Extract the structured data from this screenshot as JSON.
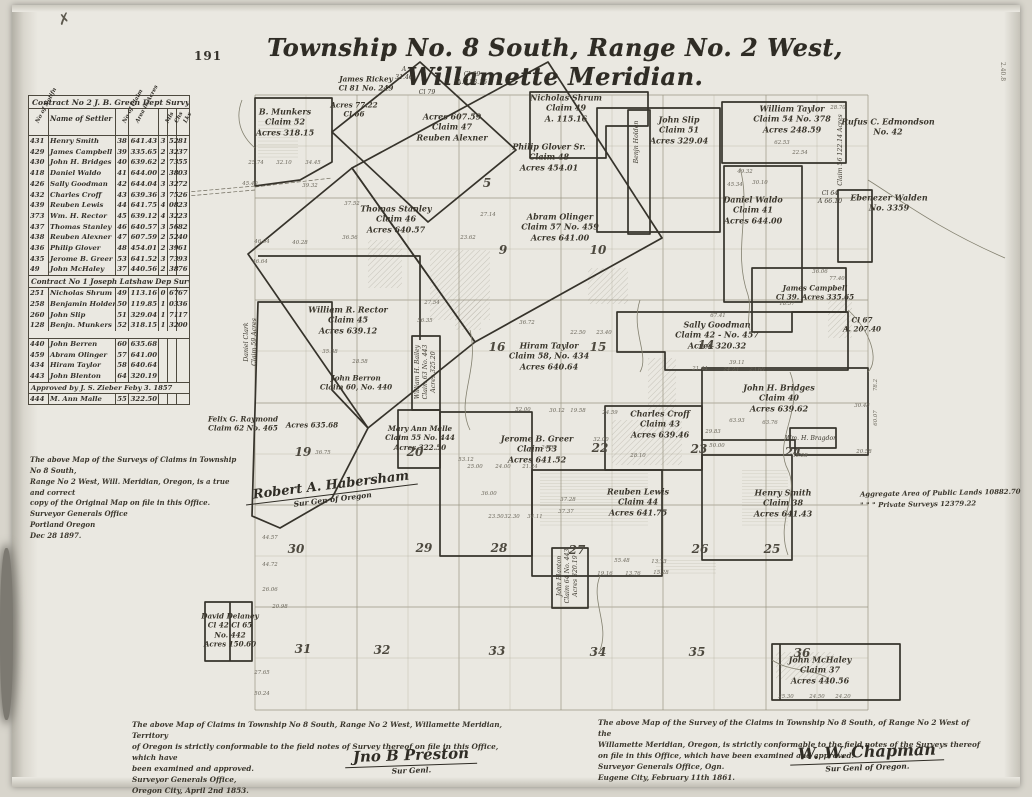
{
  "page": {
    "number": "191",
    "corner_mark": "✗",
    "right_edge_mark": "2.40.8"
  },
  "title": "Township No. 8 South, Range No. 2 West, Willamette Meridian.",
  "table": {
    "contract2_header": "Contract No 2 J. B. Green  Dept Survy",
    "contract1_header": "Contract No 1 Joseph Latshaw Dep Survy",
    "approved_note": "Approved by J. S. Zieber   Feby 3. 1857",
    "col": {
      "notif": "No of Notifn",
      "name": "Name of Settler",
      "claim": "No of Claim",
      "area": "Area in Acres",
      "m": "Mls",
      "c": "Chs",
      "l": "Lks"
    },
    "rows": [
      {
        "n": "431",
        "name": "Henry Smith",
        "c": "38",
        "a": "641.43",
        "s1": "3",
        "s2": "52",
        "s3": "81"
      },
      {
        "n": "429",
        "name": "James Campbell",
        "c": "39",
        "a": "335.65",
        "s1": "2",
        "s2": "32",
        "s3": "37"
      },
      {
        "n": "430",
        "name": "John H. Bridges",
        "c": "40",
        "a": "639.62",
        "s1": "2",
        "s2": "73",
        "s3": "55"
      },
      {
        "n": "418",
        "name": "Daniel Waldo",
        "c": "41",
        "a": "644.00",
        "s1": "2",
        "s2": "38",
        "s3": "03"
      },
      {
        "n": "426",
        "name": "Sally Goodman",
        "c": "42",
        "a": "644.04",
        "s1": "3",
        "s2": "32",
        "s3": "72"
      },
      {
        "n": "432",
        "name": "Charles Croff",
        "c": "43",
        "a": "639.36",
        "s1": "3",
        "s2": "75",
        "s3": "26"
      },
      {
        "n": "439",
        "name": "Reuben Lewis",
        "c": "44",
        "a": "641.75",
        "s1": "4",
        "s2": "08",
        "s3": "23"
      },
      {
        "n": "373",
        "name": "Wm. H. Rector",
        "c": "45",
        "a": "639.12",
        "s1": "4",
        "s2": "32",
        "s3": "23"
      },
      {
        "n": "437",
        "name": "Thomas Stanley",
        "c": "46",
        "a": "640.57",
        "s1": "3",
        "s2": "56",
        "s3": "82"
      },
      {
        "n": "438",
        "name": "Reuben Alexner",
        "c": "47",
        "a": "607.59",
        "s1": "2",
        "s2": "52",
        "s3": "40"
      },
      {
        "n": "436",
        "name": "Philip Glover",
        "c": "48",
        "a": "454.01",
        "s1": "2",
        "s2": "39",
        "s3": "61"
      },
      {
        "n": "435",
        "name": "Jerome B. Greer",
        "c": "53",
        "a": "641.52",
        "s1": "3",
        "s2": "73",
        "s3": "93"
      },
      {
        "n": "49",
        "name": "John McHaley",
        "c": "37",
        "a": "440.56",
        "s1": "2",
        "s2": "38",
        "s3": "76"
      }
    ],
    "rows2": [
      {
        "n": "251",
        "name": "Nicholas Shrum",
        "c": "49",
        "a": "113.16",
        "s1": "0",
        "s2": "67",
        "s3": "67"
      },
      {
        "n": "258",
        "name": "Benjamin Holden",
        "c": "50",
        "a": "119.85",
        "s1": "1",
        "s2": "03",
        "s3": "36"
      },
      {
        "n": "260",
        "name": "John Slip",
        "c": "51",
        "a": "329.04",
        "s1": "1",
        "s2": "71",
        "s3": "17"
      },
      {
        "n": "128",
        "name": "Benjn. Munkers",
        "c": "52",
        "a": "318.15",
        "s1": "1",
        "s2": "32",
        "s3": "00"
      }
    ],
    "rows3": [
      {
        "n": "440",
        "name": "John Berren",
        "c": "60",
        "a": "635.68",
        "s1": "",
        "s2": "",
        "s3": ""
      },
      {
        "n": "459",
        "name": "Abram Olinger",
        "c": "57",
        "a": "641.00",
        "s1": "",
        "s2": "",
        "s3": ""
      },
      {
        "n": "434",
        "name": "Hiram Taylor",
        "c": "58",
        "a": "640.64",
        "s1": "",
        "s2": "",
        "s3": ""
      },
      {
        "n": "443",
        "name": "John Blenton",
        "c": "64",
        "a": "320.19",
        "s1": "",
        "s2": "",
        "s3": ""
      }
    ],
    "rows4": [
      {
        "n": "444",
        "name": "M. Ann Malle",
        "c": "55",
        "a": "322.50",
        "s1": "",
        "s2": "",
        "s3": ""
      }
    ]
  },
  "map": {
    "claims": [
      {
        "id": "munkers",
        "x": 285,
        "y": 122,
        "text": "B. Munkers\nClaim 52\nAcres 318.15"
      },
      {
        "id": "rickey",
        "x": 366,
        "y": 84,
        "cls": "sm",
        "text": "James Rickey\nCl 81  No. 249"
      },
      {
        "id": "a3146",
        "x": 404,
        "y": 74,
        "cls": "xs",
        "text": "A\n31.46"
      },
      {
        "id": "cl79",
        "x": 427,
        "y": 93,
        "cls": "xs",
        "text": "Cl 79"
      },
      {
        "id": "cl69",
        "x": 472,
        "y": 79,
        "cls": "xs",
        "text": "Cl 69\nA. 153.15"
      },
      {
        "id": "cl66",
        "x": 354,
        "y": 110,
        "cls": "sm",
        "text": "Acres 77.22\nCl 66"
      },
      {
        "id": "alexander",
        "x": 452,
        "y": 127,
        "text": "Acres 607.59\nClaim 47\nReuben Alexner"
      },
      {
        "id": "shrum",
        "x": 566,
        "y": 108,
        "text": "Nicholas Shrum\nClaim 49\nA. 115.16"
      },
      {
        "id": "glover",
        "x": 549,
        "y": 157,
        "text": "Philip Glover Sr.\nClaim 48\nAcres 454.01"
      },
      {
        "id": "slip",
        "x": 679,
        "y": 130,
        "text": "John Slip\nClaim 51\nAcres 329.04"
      },
      {
        "id": "holden-vert",
        "x": 637,
        "y": 142,
        "rot": -90,
        "cls": "xs",
        "text": "Benjn Holden"
      },
      {
        "id": "wtaylor",
        "x": 792,
        "y": 119,
        "text": "William Taylor\nClaim 54  No. 378\nAcres 248.59"
      },
      {
        "id": "edmondson",
        "x": 888,
        "y": 127,
        "text": "Rufus C. Edmondson\nNo. 42"
      },
      {
        "id": "claim56-vert",
        "x": 841,
        "y": 150,
        "rot": -90,
        "cls": "xs",
        "text": "Claim 56   122.14 Acres"
      },
      {
        "id": "waldo",
        "x": 753,
        "y": 210,
        "text": "Daniel Waldo\nClaim 41\nAcres 644.00"
      },
      {
        "id": "walden",
        "x": 889,
        "y": 203,
        "text": "Ebenezer Walden\nNo. 3359"
      },
      {
        "id": "cl64",
        "x": 830,
        "y": 198,
        "cls": "xs",
        "text": "Cl 64\nA 66.10"
      },
      {
        "id": "stanley",
        "x": 396,
        "y": 219,
        "text": "Thomas Stanley\nClaim 46\nAcres 640.57"
      },
      {
        "id": "olinger",
        "x": 560,
        "y": 227,
        "text": "Abram Olinger\nClaim 57  No. 459\nAcres 641.00"
      },
      {
        "id": "campbell",
        "x": 815,
        "y": 293,
        "cls": "sm",
        "text": "James Campbell\nCl 39. Acres 335.65"
      },
      {
        "id": "cl67",
        "x": 862,
        "y": 325,
        "cls": "sm",
        "text": "Cl 67\nA. 207.40"
      },
      {
        "id": "rector",
        "x": 348,
        "y": 320,
        "text": "William R. Rector\nClaim 45\nAcres 639.12"
      },
      {
        "id": "berren",
        "x": 356,
        "y": 383,
        "cls": "sm",
        "text": "John Berron\nClaim 60, No. 440"
      },
      {
        "id": "berren-acres",
        "x": 312,
        "y": 425,
        "cls": "sm",
        "text": "Acres 635.68"
      },
      {
        "id": "raymond",
        "x": 243,
        "y": 424,
        "cls": "sm",
        "text": "Felix G. Raymond\nClaim 62  No. 465"
      },
      {
        "id": "bailey-vert",
        "x": 426,
        "y": 372,
        "rot": -90,
        "cls": "xs",
        "text": "William H. Bailey\nClaim 63  No. 443\nAcres 325.20"
      },
      {
        "id": "htaylor",
        "x": 549,
        "y": 356,
        "text": "Hiram Taylor\nClaim 58, No. 434\nAcres 640.64"
      },
      {
        "id": "goodman",
        "x": 717,
        "y": 335,
        "text": "Sally Goodman\nClaim 42 - No. 457\nAcres 320.32"
      },
      {
        "id": "bridges",
        "x": 779,
        "y": 398,
        "text": "John H. Bridges\nClaim 40\nAcres 639.62"
      },
      {
        "id": "bragdon",
        "x": 811,
        "y": 439,
        "cls": "xs",
        "text": "Wm. H. Bragdon"
      },
      {
        "id": "croff",
        "x": 660,
        "y": 424,
        "text": "Charles Croff\nClaim 43\nAcres 639.46"
      },
      {
        "id": "malle",
        "x": 420,
        "y": 438,
        "cls": "sm",
        "text": "Mary Ann Malle\nClaim 55  No. 444\nAcres 322.50"
      },
      {
        "id": "greer",
        "x": 537,
        "y": 449,
        "text": "Jerome B. Greer\nClaim 53\nAcres 641.52"
      },
      {
        "id": "rlewis",
        "x": 638,
        "y": 502,
        "text": "Reuben Lewis\nClaim 44\nAcres 641.75"
      },
      {
        "id": "hsmith",
        "x": 783,
        "y": 503,
        "text": "Henry Smith\nClaim 38\nAcres 641.43"
      },
      {
        "id": "blanton-vert",
        "x": 568,
        "y": 576,
        "rot": -90,
        "cls": "xs",
        "text": "John Blanton\nClaim 64  No. 443\nAcres 320.19"
      },
      {
        "id": "delaney",
        "x": 230,
        "y": 630,
        "cls": "sm",
        "text": "David Delaney\nCl 42   Cl 65\nNo. 442\nAcres 150.60"
      },
      {
        "id": "mchaley",
        "x": 820,
        "y": 670,
        "text": "John McHaley\nClaim 37\nAcres 440.56"
      },
      {
        "id": "clark-vert",
        "x": 251,
        "y": 342,
        "rot": -90,
        "cls": "xs",
        "text": "Daniel Clark\nClaim 59  Acres"
      }
    ],
    "sections": [
      {
        "n": "5",
        "x": 487,
        "y": 183
      },
      {
        "n": "9",
        "x": 503,
        "y": 250
      },
      {
        "n": "10",
        "x": 598,
        "y": 250
      },
      {
        "n": "16",
        "x": 497,
        "y": 347
      },
      {
        "n": "15",
        "x": 598,
        "y": 347
      },
      {
        "n": "14",
        "x": 706,
        "y": 345
      },
      {
        "n": "19",
        "x": 303,
        "y": 452
      },
      {
        "n": "20",
        "x": 415,
        "y": 452
      },
      {
        "n": "22",
        "x": 600,
        "y": 448
      },
      {
        "n": "23",
        "x": 699,
        "y": 449
      },
      {
        "n": "24",
        "x": 793,
        "y": 452
      },
      {
        "n": "30",
        "x": 296,
        "y": 549
      },
      {
        "n": "29",
        "x": 424,
        "y": 548
      },
      {
        "n": "28",
        "x": 499,
        "y": 548
      },
      {
        "n": "27",
        "x": 577,
        "y": 550
      },
      {
        "n": "26",
        "x": 700,
        "y": 549
      },
      {
        "n": "25",
        "x": 772,
        "y": 549
      },
      {
        "n": "31",
        "x": 303,
        "y": 649
      },
      {
        "n": "32",
        "x": 382,
        "y": 650
      },
      {
        "n": "33",
        "x": 497,
        "y": 651
      },
      {
        "n": "34",
        "x": 598,
        "y": 652
      },
      {
        "n": "35",
        "x": 697,
        "y": 652
      },
      {
        "n": "36",
        "x": 802,
        "y": 653
      }
    ],
    "measurements": [
      {
        "t": "25.74",
        "x": 256,
        "y": 163
      },
      {
        "t": "32.10",
        "x": 284,
        "y": 163
      },
      {
        "t": "34.45",
        "x": 313,
        "y": 163
      },
      {
        "t": "45.40",
        "x": 250,
        "y": 184
      },
      {
        "t": "39.32",
        "x": 310,
        "y": 186
      },
      {
        "t": "37.52",
        "x": 352,
        "y": 204
      },
      {
        "t": "27.14",
        "x": 488,
        "y": 215
      },
      {
        "t": "23.62",
        "x": 468,
        "y": 238
      },
      {
        "t": "36.56",
        "x": 350,
        "y": 238
      },
      {
        "t": "40.28",
        "x": 300,
        "y": 243
      },
      {
        "t": "46.04",
        "x": 262,
        "y": 242
      },
      {
        "t": "46.64",
        "x": 260,
        "y": 262
      },
      {
        "t": "36.72",
        "x": 527,
        "y": 323
      },
      {
        "t": "22.50",
        "x": 578,
        "y": 333
      },
      {
        "t": "23.40",
        "x": 604,
        "y": 333
      },
      {
        "t": "67.41",
        "x": 718,
        "y": 316
      },
      {
        "t": "39.11",
        "x": 737,
        "y": 363
      },
      {
        "t": "21.44",
        "x": 700,
        "y": 369
      },
      {
        "t": "24.23",
        "x": 731,
        "y": 370
      },
      {
        "t": "23.60",
        "x": 757,
        "y": 370
      },
      {
        "t": "63.93",
        "x": 737,
        "y": 421
      },
      {
        "t": "63.76",
        "x": 770,
        "y": 423
      },
      {
        "t": "29.83",
        "x": 713,
        "y": 432
      },
      {
        "t": "50.00",
        "x": 717,
        "y": 446
      },
      {
        "t": "35.58",
        "x": 800,
        "y": 456
      },
      {
        "t": "30.48",
        "x": 862,
        "y": 406
      },
      {
        "t": "20.58",
        "x": 864,
        "y": 452
      },
      {
        "t": "52.00",
        "x": 523,
        "y": 410
      },
      {
        "t": "30.12",
        "x": 557,
        "y": 411
      },
      {
        "t": "19.58",
        "x": 578,
        "y": 411
      },
      {
        "t": "24.59",
        "x": 610,
        "y": 413
      },
      {
        "t": "32.00",
        "x": 601,
        "y": 440
      },
      {
        "t": "24.58",
        "x": 549,
        "y": 448
      },
      {
        "t": "28.10",
        "x": 638,
        "y": 456
      },
      {
        "t": "25.00",
        "x": 475,
        "y": 467
      },
      {
        "t": "24.00",
        "x": 503,
        "y": 467
      },
      {
        "t": "21.24",
        "x": 530,
        "y": 467
      },
      {
        "t": "53.12",
        "x": 466,
        "y": 460
      },
      {
        "t": "36.00",
        "x": 489,
        "y": 494
      },
      {
        "t": "37.28",
        "x": 568,
        "y": 500
      },
      {
        "t": "37.37",
        "x": 566,
        "y": 512
      },
      {
        "t": "34.11",
        "x": 535,
        "y": 517
      },
      {
        "t": "32.30",
        "x": 512,
        "y": 517
      },
      {
        "t": "23.50",
        "x": 496,
        "y": 517
      },
      {
        "t": "19.16",
        "x": 605,
        "y": 574
      },
      {
        "t": "13.76",
        "x": 633,
        "y": 574
      },
      {
        "t": "15.28",
        "x": 661,
        "y": 573
      },
      {
        "t": "55.48",
        "x": 622,
        "y": 561
      },
      {
        "t": "13.73",
        "x": 659,
        "y": 562
      },
      {
        "t": "25.30",
        "x": 786,
        "y": 697
      },
      {
        "t": "24.50",
        "x": 817,
        "y": 697
      },
      {
        "t": "24.20",
        "x": 843,
        "y": 697
      },
      {
        "t": "27.65",
        "x": 262,
        "y": 673
      },
      {
        "t": "50.24",
        "x": 262,
        "y": 694
      },
      {
        "t": "20.98",
        "x": 280,
        "y": 607
      },
      {
        "t": "44.57",
        "x": 270,
        "y": 538
      },
      {
        "t": "44.72",
        "x": 270,
        "y": 565
      },
      {
        "t": "26.06",
        "x": 270,
        "y": 590
      },
      {
        "t": "62.53",
        "x": 782,
        "y": 143
      },
      {
        "t": "22.54",
        "x": 800,
        "y": 153
      },
      {
        "t": "49.32",
        "x": 745,
        "y": 172
      },
      {
        "t": "30.10",
        "x": 760,
        "y": 183
      },
      {
        "t": "45.34",
        "x": 735,
        "y": 185
      },
      {
        "t": "28.70",
        "x": 838,
        "y": 108
      },
      {
        "t": "36.06",
        "x": 820,
        "y": 272
      },
      {
        "t": "77.40",
        "x": 837,
        "y": 279
      },
      {
        "t": "18.57",
        "x": 787,
        "y": 304
      },
      {
        "t": "56.35",
        "x": 425,
        "y": 321
      },
      {
        "t": "27.54",
        "x": 432,
        "y": 303
      },
      {
        "t": "35.38",
        "x": 330,
        "y": 352
      },
      {
        "t": "28.58",
        "x": 360,
        "y": 362
      },
      {
        "t": "36.75",
        "x": 323,
        "y": 453
      },
      {
        "t": "78.2",
        "x": 876,
        "y": 385,
        "rot": -90
      },
      {
        "t": "60.07",
        "x": 876,
        "y": 418,
        "rot": -90
      }
    ]
  },
  "notes": {
    "aggregate": "Aggregate Area of Public Lands 10882.70\n\"        \"        \"   Private Surveys 12379.22",
    "copy_cert": "The above Map of the Surveys of Claims in Township No 8 South,\nRange No 2 West, Will. Meridian, Oregon, is a true and correct\ncopy of the Original Map on file in this Office.\nSurveyor Generals Office\nPortland Oregon\nDec 28 1897.",
    "copy_sig": "Robert A. Habersham",
    "copy_sig_title": "Sur Gen of Oregon",
    "left_cert": "The above Map of Claims in Township No 8 South, Range No 2 West, Willamette Meridian, Territory\nof Oregon is strictly conformable to the field notes of Survey thereof on file in this Office, which have\nbeen examined and approved.\nSurveyor Generals Office,\nOregon City, April 2nd 1853.",
    "left_sig": "Jno B Preston",
    "left_sig_title": "Sur Genl.",
    "right_cert": "The above Map of the Survey of the Claims in Township No 8 South, of Range No 2 West of the\nWillamette Meridian, Oregon, is strictly conformable to the field notes of the Surveys thereof\non file in this Office, which have been examined and approved.\nSurveyor Generals Office, Ogn.\nEugene City, February 11th 1861.",
    "right_sig": "W. W. Chapman",
    "right_sig_title": "Sur Genl of Oregon."
  }
}
